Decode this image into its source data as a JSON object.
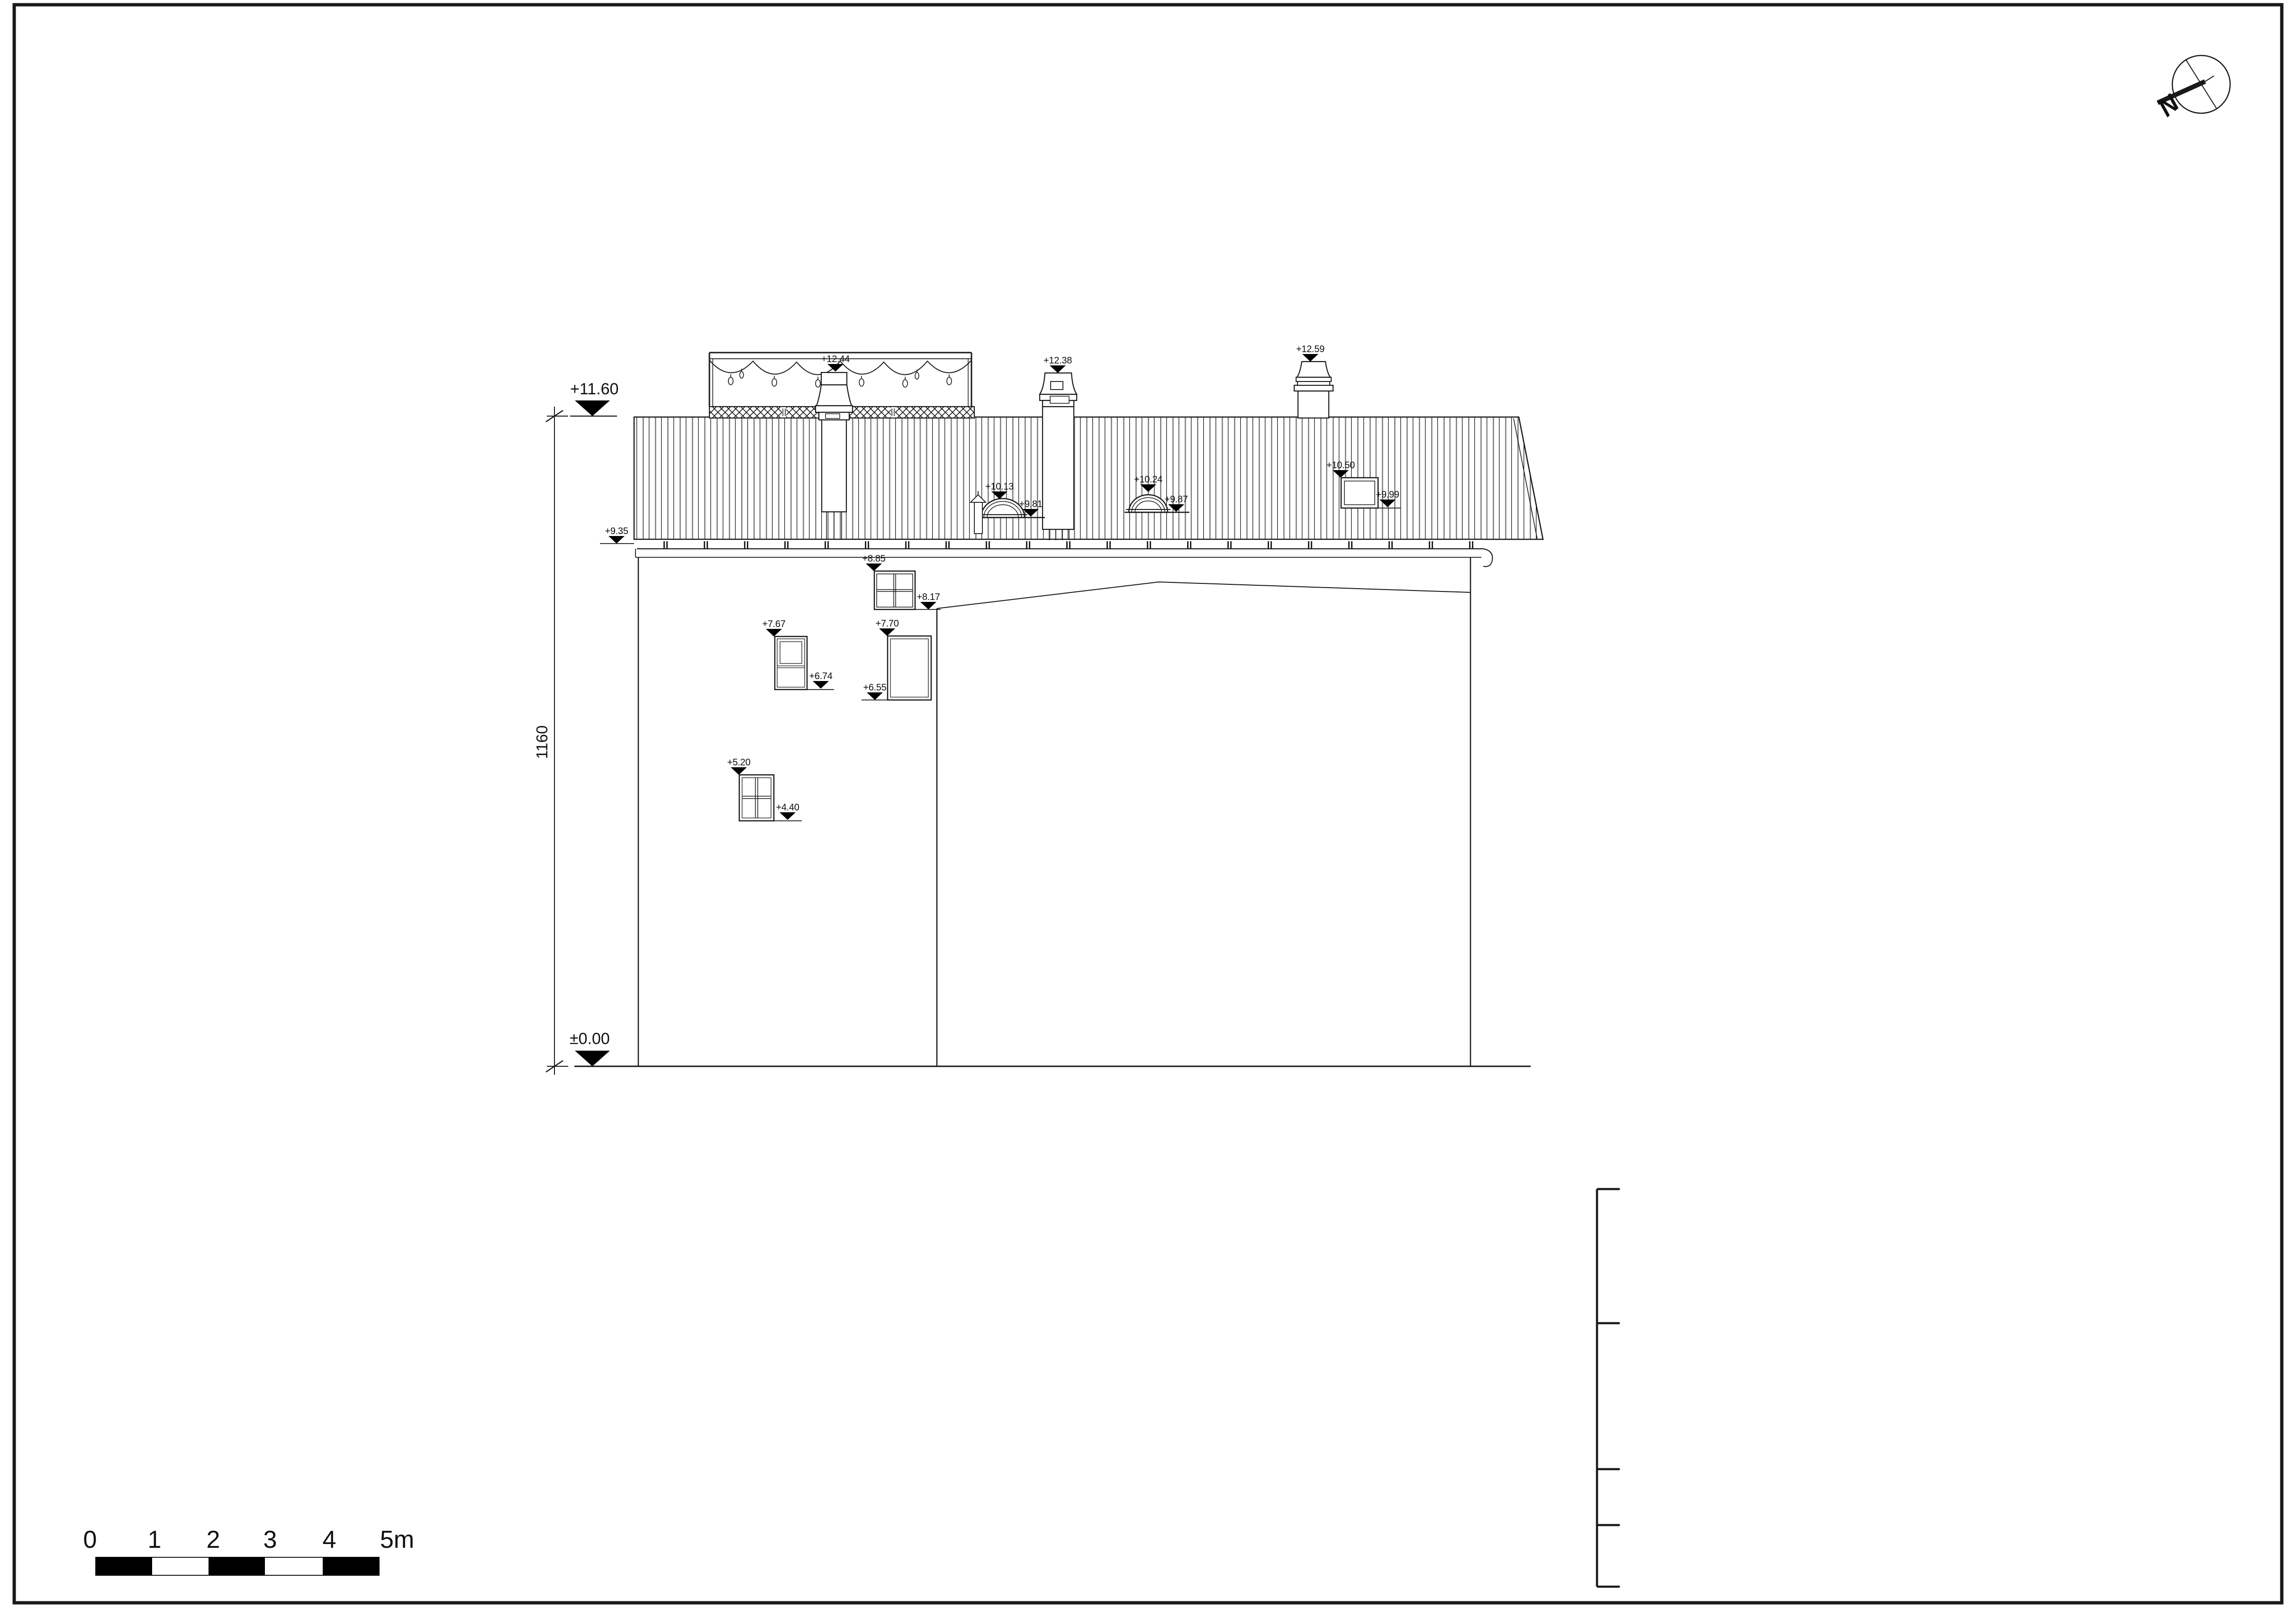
{
  "levels": {
    "top": "+11.60",
    "ground": "±0.00",
    "chimney_terrace": "+12.44",
    "chimney_mid": "+12.38",
    "chimney_right": "+12.59",
    "dormer_left_top": "+10.13",
    "dormer_left_base": "+9.81",
    "dormer_right_top": "+10.24",
    "dormer_right_base": "+9.87",
    "skylight_top": "+10.50",
    "skylight_base": "+9.99",
    "eaves": "+9.35",
    "attic_window_top": "+8.85",
    "attic_window_sill": "+8.17",
    "window_left_top": "+7.67",
    "window_left_sill": "+6.74",
    "window_right_top": "+7.70",
    "window_right_sill": "+6.55",
    "lower_window_top": "+5.20",
    "lower_window_sill": "+4.40"
  },
  "dimensions": {
    "overall_height": "1160"
  },
  "scale_bar": {
    "ticks": [
      "0",
      "1",
      "2",
      "3",
      "4",
      "5m"
    ]
  },
  "compass": {
    "north_label": "N"
  },
  "colors": {
    "line": "#1a1a1a",
    "hatch_gray": "#808080",
    "marker_fill": "#000000"
  }
}
